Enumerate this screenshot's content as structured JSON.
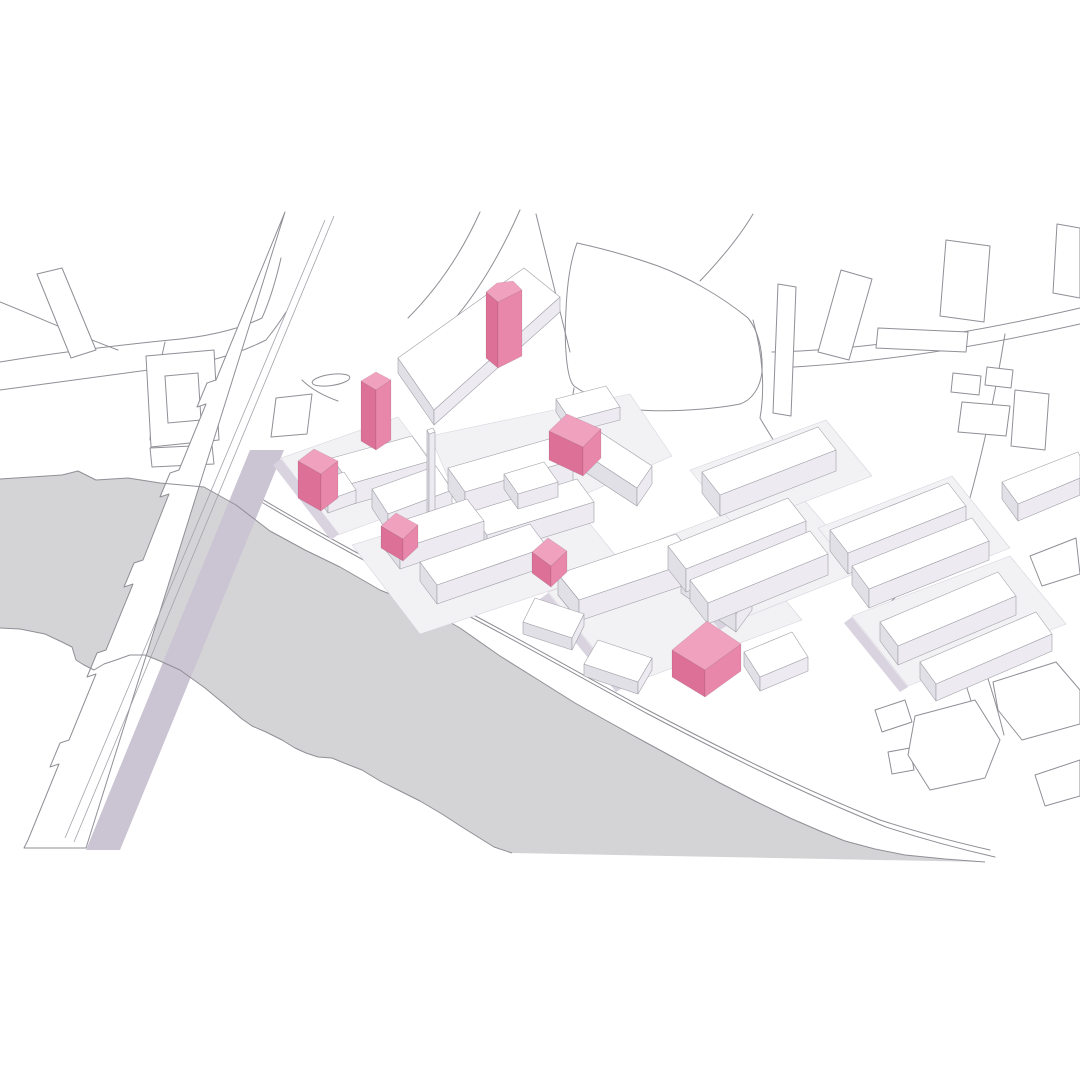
{
  "diagram": {
    "type": "axonometric-site-plan",
    "highlight_count": 7,
    "highlight_ids": [
      "highlighted-building-1",
      "highlighted-building-2",
      "highlighted-building-3",
      "highlighted-building-4",
      "highlighted-building-5",
      "highlighted-building-6",
      "highlighted-building-7"
    ]
  },
  "colors": {
    "background": "#ffffff",
    "water": "#d4d4d6",
    "outline": "#8f8f96",
    "outline_light": "#a3a3ab",
    "building_top": "#ffffff",
    "building_side_sw": "#e2e0e7",
    "building_side_se": "#edebf1",
    "slab": "#f2f1f4",
    "slab_stroke": "#d7d4dc",
    "shadow": "#d9d3e0",
    "bridge_shadow": "#cbc4d3",
    "highlight_top": "#f0a1bd",
    "highlight_sw": "#dc7097",
    "highlight_se": "#e987aa",
    "prism_stroke": "#a0a0a8"
  },
  "scene": {
    "water_points": "0,479 62,475 78,471 96,480 128,478 160,483 204,487 236,505 270,531 305,550 340,567 380,590 425,608 460,628 500,656 540,681 575,703 607,721 645,742 680,761 720,783 755,801 790,818 820,831 845,841 875,849 905,855 945,859 985,862 512,853 494,847 478,837 462,827 442,814 420,801 398,790 380,781 362,770 344,763 332,758 318,757 306,753 295,748 282,740 266,732 252,726 242,719 228,707 205,688 180,670 160,661 145,655 130,655 116,660 104,664 94,670 84,665 76,660 72,647 62,642 45,634 20,629 0,628",
    "shore_paths": [
      "M 0,479 L 62,475 L 78,471 L 96,480 L 128,478 L 160,483 L 204,487 L 236,505",
      "M 236,505 L 270,531 L 305,550 L 340,567 L 380,590 L 425,608 L 460,628 L 500,656 L 540,681 L 575,703 L 607,721 L 645,742 L 680,761 L 720,783 L 755,801 L 790,818 L 820,831 L 845,841 L 875,849 L 905,855 L 945,859 L 985,862",
      "M 512,853 L 494,847 L 478,837 L 462,827 L 442,814 L 420,801 L 398,790 L 380,781 L 362,770 L 344,763 L 332,758 L 318,757 L 306,753 L 295,748 L 282,740 L 266,732 L 252,726 L 242,719 L 228,707 L 205,688 L 180,670 L 160,661 L 145,655 L 130,655 L 116,660 L 104,664 L 94,670 L 84,665 L 76,660 L 72,647 L 62,642 L 45,634 L 20,629 L 0,628"
    ],
    "bridge": {
      "body": "M 285,212 L 216,380 L 207,383 L 197,407 L 206,404 L 179,470 L 170,473 L 160,497 L 169,494 L 143,560 L 134,563 L 124,587 L 133,584 L 106,650 L 97,653 L 87,677 L 96,674 L 69,740 L 60,743 L 50,767 L 59,764 L 28,840 L 24,848 L 86,848 Z",
      "shadow_points": "250,450 284,450 120,850 86,850",
      "inner_lines": [
        "M 334,216 L 74,842",
        "M 325,220 L 65,838"
      ]
    },
    "roads": [
      "M 0,362 C 60,352 120,345 170,340 C 205,337 237,330 262,318",
      "M 0,390 C 70,380 130,372 178,366 C 212,362 242,352 266,340",
      "M 262,318 C 270,300 276,280 281,258",
      "M 266,340 C 274,330 280,322 286,312",
      "M 165,342 C 157,375 152,408 150,440",
      "M 0,302 C 40,318 80,336 118,350",
      "M 480,212 C 462,252 438,288 408,318",
      "M 520,210 C 500,255 478,292 452,322",
      "M 536,214 C 548,262 560,310 570,352",
      "M 700,281 C 722,258 740,236 753,214",
      "M 772,352 C 860,350 960,336 1080,308",
      "M 776,368 C 865,364 965,350 1080,324",
      "M 1005,334 C 996,390 984,448 968,505",
      "M 968,505 C 945,545 915,580 882,610",
      "M 753,320 C 763,355 765,390 760,418",
      "M 760,418 C 776,446 792,468 808,488",
      "M 574,388 C 570,412 568,430 568,448",
      "M 940,612 C 958,660 972,700 982,740",
      "M 962,606 C 980,652 994,694 1004,735",
      "M 302,380 C 312,390 324,396 338,401",
      "M 250,492 C 310,528 370,560 430,592 C 500,628 570,668 640,706 C 720,748 800,788 880,820 C 920,833 955,842 990,850",
      "M 258,500 C 318,536 378,568 438,600 C 508,636 578,676 648,714 C 728,756 806,795 886,827 C 926,840 960,849 995,857"
    ],
    "park": "M 577,243 C 600,248 630,256 658,266 C 685,276 720,295 748,318 C 758,330 763,350 762,372 C 760,388 752,400 740,404 C 710,410 665,412 640,410 C 615,408 588,396 574,386 C 566,378 564,340 566,310 C 567,285 570,262 577,243 Z",
    "island": {
      "cx": 331,
      "cy": 380,
      "rx": 19,
      "ry": 5.5,
      "rot": -8
    },
    "flat_buildings": [
      "37,274 62,268 96,350 71,358",
      "146,356 214,350 219,440 151,447",
      "150,448 212,445 214,464 152,467",
      "276,398 312,394 307,434 271,437",
      "818,352 841,270 872,279 849,360",
      "946,240 990,246 984,322 940,316",
      "878,328 968,332 966,352 876,348",
      "953,373 981,376 979,395 951,392",
      "987,367 1013,370 1011,388 985,385",
      "1015,390 1049,394 1045,450 1011,446",
      "962,402 1010,406 1006,436 958,432",
      "1057,224 1080,228 1080,298 1053,293",
      "778,284 796,287 791,416 773,413",
      "888,752 910,748 914,770 892,774",
      "915,716 975,700 1000,740 985,778 930,790 908,755",
      "993,682 1056,662 1080,690 1080,724 1022,740 998,710",
      "1035,775 1080,760 1080,796 1045,806",
      "875,710 905,700 912,722 882,732",
      "1030,556 1076,538 1080,574 1042,586"
    ],
    "courtyards": [
      "165,376 198,373 201,420 168,423"
    ],
    "slabs": [
      "281,458 398,417 455,492 338,535",
      "430,436 630,394 672,456 476,542",
      "352,545 556,482 624,566 420,634",
      "548,592 726,530 802,620 624,686",
      "658,540 794,488 864,570 728,624",
      "818,528 952,476 1010,548 876,600",
      "852,616 1010,556 1066,624 908,686",
      "690,470 826,420 872,476 736,528"
    ],
    "shadows": [
      "281,459 339,534 331,540 273,465",
      "548,593 624,687 616,692 540,599",
      "658,541 728,625 720,630 650,547",
      "852,617 908,687 900,692 844,623"
    ],
    "white_prisms": [
      {
        "top": [
          [
            398,
            358
          ],
          [
            524,
            268
          ],
          [
            560,
            297
          ],
          [
            434,
            410
          ]
        ],
        "h": 15
      },
      {
        "top": [
          [
            332,
            458
          ],
          [
            412,
            436
          ],
          [
            430,
            461
          ],
          [
            350,
            484
          ]
        ],
        "h": 21
      },
      {
        "top": [
          [
            372,
            489
          ],
          [
            436,
            466
          ],
          [
            452,
            490
          ],
          [
            388,
            514
          ]
        ],
        "h": 19
      },
      {
        "top": [
          [
            316,
            482
          ],
          [
            344,
            472
          ],
          [
            356,
            490
          ],
          [
            328,
            500
          ]
        ],
        "h": 13
      },
      {
        "top": [
          [
            448,
            468
          ],
          [
            556,
            437
          ],
          [
            573,
            460
          ],
          [
            465,
            492
          ]
        ],
        "h": 22
      },
      {
        "top": [
          [
            470,
            512
          ],
          [
            577,
            479
          ],
          [
            594,
            502
          ],
          [
            487,
            535
          ]
        ],
        "h": 20
      },
      {
        "top": [
          [
            427,
            430
          ],
          [
            433,
            428
          ],
          [
            435,
            432
          ],
          [
            429,
            434
          ]
        ],
        "h": 88
      },
      {
        "top": [
          [
            556,
            399
          ],
          [
            606,
            386
          ],
          [
            620,
            407
          ],
          [
            570,
            420
          ]
        ],
        "h": 13
      },
      {
        "top": [
          [
            600,
            432
          ],
          [
            652,
            466
          ],
          [
            637,
            488
          ],
          [
            585,
            454
          ]
        ],
        "h": 18
      },
      {
        "top": [
          [
            504,
            474
          ],
          [
            544,
            462
          ],
          [
            558,
            482
          ],
          [
            518,
            494
          ]
        ],
        "h": 15
      },
      {
        "top": [
          [
            383,
            527
          ],
          [
            467,
            499
          ],
          [
            484,
            521
          ],
          [
            400,
            549
          ]
        ],
        "h": 20
      },
      {
        "top": [
          [
            420,
            562
          ],
          [
            530,
            524
          ],
          [
            547,
            547
          ],
          [
            437,
            585
          ]
        ],
        "h": 19
      },
      {
        "top": [
          [
            558,
            574
          ],
          [
            676,
            534
          ],
          [
            697,
            560
          ],
          [
            579,
            600
          ]
        ],
        "h": 21
      },
      {
        "top": [
          [
            697,
            553
          ],
          [
            752,
            592
          ],
          [
            736,
            614
          ],
          [
            681,
            575
          ]
        ],
        "h": 18
      },
      {
        "top": [
          [
            598,
            640
          ],
          [
            652,
            658
          ],
          [
            638,
            682
          ],
          [
            584,
            664
          ]
        ],
        "h": 12
      },
      {
        "top": [
          [
            744,
            652
          ],
          [
            792,
            632
          ],
          [
            808,
            657
          ],
          [
            760,
            677
          ]
        ],
        "h": 14
      },
      {
        "top": [
          [
            535,
            598
          ],
          [
            584,
            614
          ],
          [
            572,
            638
          ],
          [
            523,
            622
          ]
        ],
        "h": 12
      },
      {
        "top": [
          [
            668,
            546
          ],
          [
            788,
            498
          ],
          [
            806,
            521
          ],
          [
            686,
            569
          ]
        ],
        "h": 23
      },
      {
        "top": [
          [
            690,
            580
          ],
          [
            810,
            531
          ],
          [
            828,
            554
          ],
          [
            708,
            603
          ]
        ],
        "h": 21
      },
      {
        "top": [
          [
            702,
            472
          ],
          [
            818,
            427
          ],
          [
            836,
            450
          ],
          [
            720,
            495
          ]
        ],
        "h": 21
      },
      {
        "top": [
          [
            830,
            530
          ],
          [
            948,
            483
          ],
          [
            966,
            506
          ],
          [
            848,
            553
          ]
        ],
        "h": 21
      },
      {
        "top": [
          [
            852,
            566
          ],
          [
            972,
            518
          ],
          [
            989,
            541
          ],
          [
            869,
            589
          ]
        ],
        "h": 19
      },
      {
        "top": [
          [
            880,
            622
          ],
          [
            998,
            572
          ],
          [
            1016,
            596
          ],
          [
            898,
            646
          ]
        ],
        "h": 19
      },
      {
        "top": [
          [
            920,
            662
          ],
          [
            1036,
            612
          ],
          [
            1052,
            634
          ],
          [
            936,
            684
          ]
        ],
        "h": 17
      },
      {
        "top": [
          [
            1002,
            482
          ],
          [
            1078,
            452
          ],
          [
            1080,
            456
          ],
          [
            1080,
            478
          ],
          [
            1018,
            504
          ]
        ],
        "h": 17
      }
    ],
    "highlight_prisms": [
      {
        "id": "highlighted-building-1",
        "top": [
          [
            486,
            292
          ],
          [
            497,
            283
          ],
          [
            513,
            281
          ],
          [
            522,
            290
          ],
          [
            498,
            302
          ]
        ],
        "h": 66
      },
      {
        "id": "highlighted-building-2",
        "top": [
          [
            361,
            381
          ],
          [
            376,
            372
          ],
          [
            391,
            380
          ],
          [
            376,
            390
          ]
        ],
        "h": 60
      },
      {
        "id": "highlighted-building-3",
        "top": [
          [
            298,
            461
          ],
          [
            314,
            449
          ],
          [
            338,
            461
          ],
          [
            321,
            474
          ]
        ],
        "h": 37
      },
      {
        "id": "highlighted-building-4",
        "top": [
          [
            549,
            431
          ],
          [
            567,
            414
          ],
          [
            601,
            429
          ],
          [
            583,
            447
          ]
        ],
        "h": 29
      },
      {
        "id": "highlighted-building-5",
        "top": [
          [
            381,
            526
          ],
          [
            396,
            513
          ],
          [
            418,
            525
          ],
          [
            403,
            539
          ]
        ],
        "h": 22
      },
      {
        "id": "highlighted-building-6",
        "top": [
          [
            532,
            552
          ],
          [
            548,
            538
          ],
          [
            567,
            551
          ],
          [
            551,
            566
          ]
        ],
        "h": 21
      },
      {
        "id": "highlighted-building-7",
        "top": [
          [
            672,
            650
          ],
          [
            707,
            621
          ],
          [
            741,
            644
          ],
          [
            705,
            670
          ]
        ],
        "h": 27
      }
    ]
  }
}
